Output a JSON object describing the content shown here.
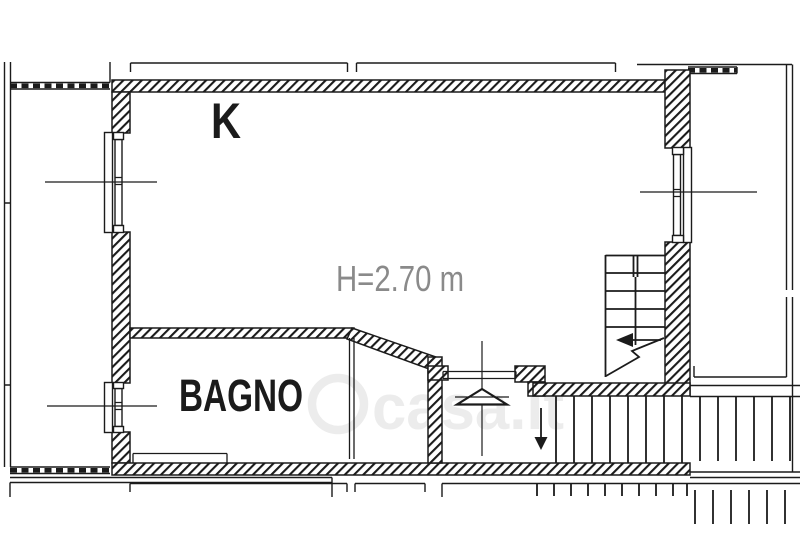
{
  "page": {
    "type": "floor-plan"
  },
  "labels": {
    "room_k": "K",
    "room_bagno": "BAGNO",
    "ceiling_height": "H=2.70 m"
  },
  "watermark": {
    "text": "casa.it"
  },
  "colors": {
    "line": "#1b1b1b",
    "dimension_text": "#8a8a8a",
    "watermark": "#ececec",
    "background": "#ffffff"
  }
}
